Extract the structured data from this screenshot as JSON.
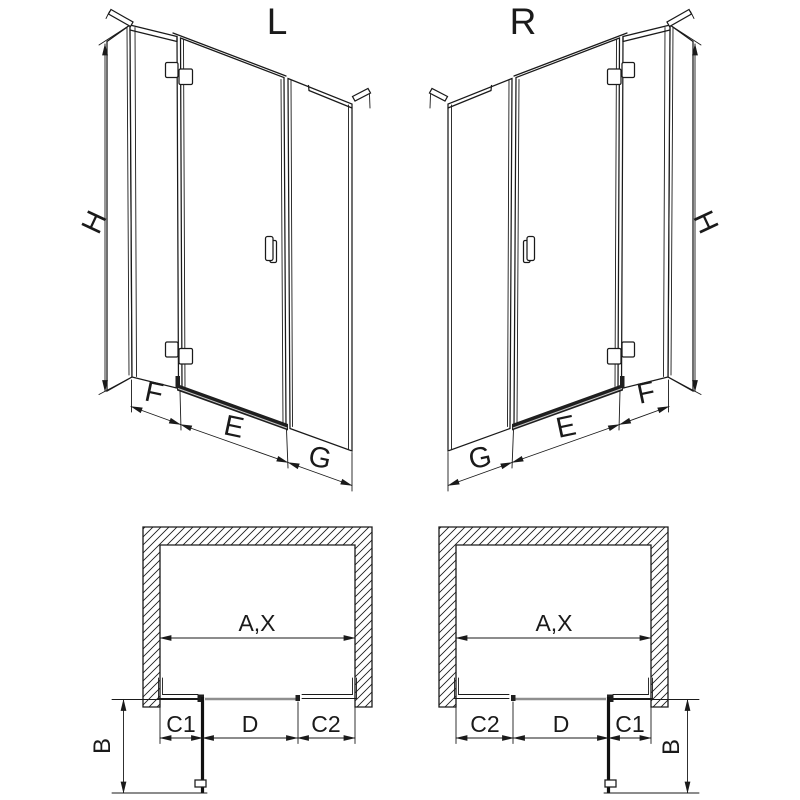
{
  "drawing": {
    "variant_left_title": "L",
    "variant_right_title": "R",
    "dimension_labels": {
      "height": "H",
      "side_fixed_width": "F",
      "door_opening_width": "E",
      "fixed_panel_width": "G",
      "total_width": "A,X",
      "c1": "C1",
      "door_width": "D",
      "c2": "C2",
      "door_projection": "B"
    },
    "colors": {
      "line": "#1a1a1a",
      "threshold_dark": "#1f1f1f",
      "threshold_gray": "#8f8f8f",
      "background": "#ffffff"
    }
  }
}
